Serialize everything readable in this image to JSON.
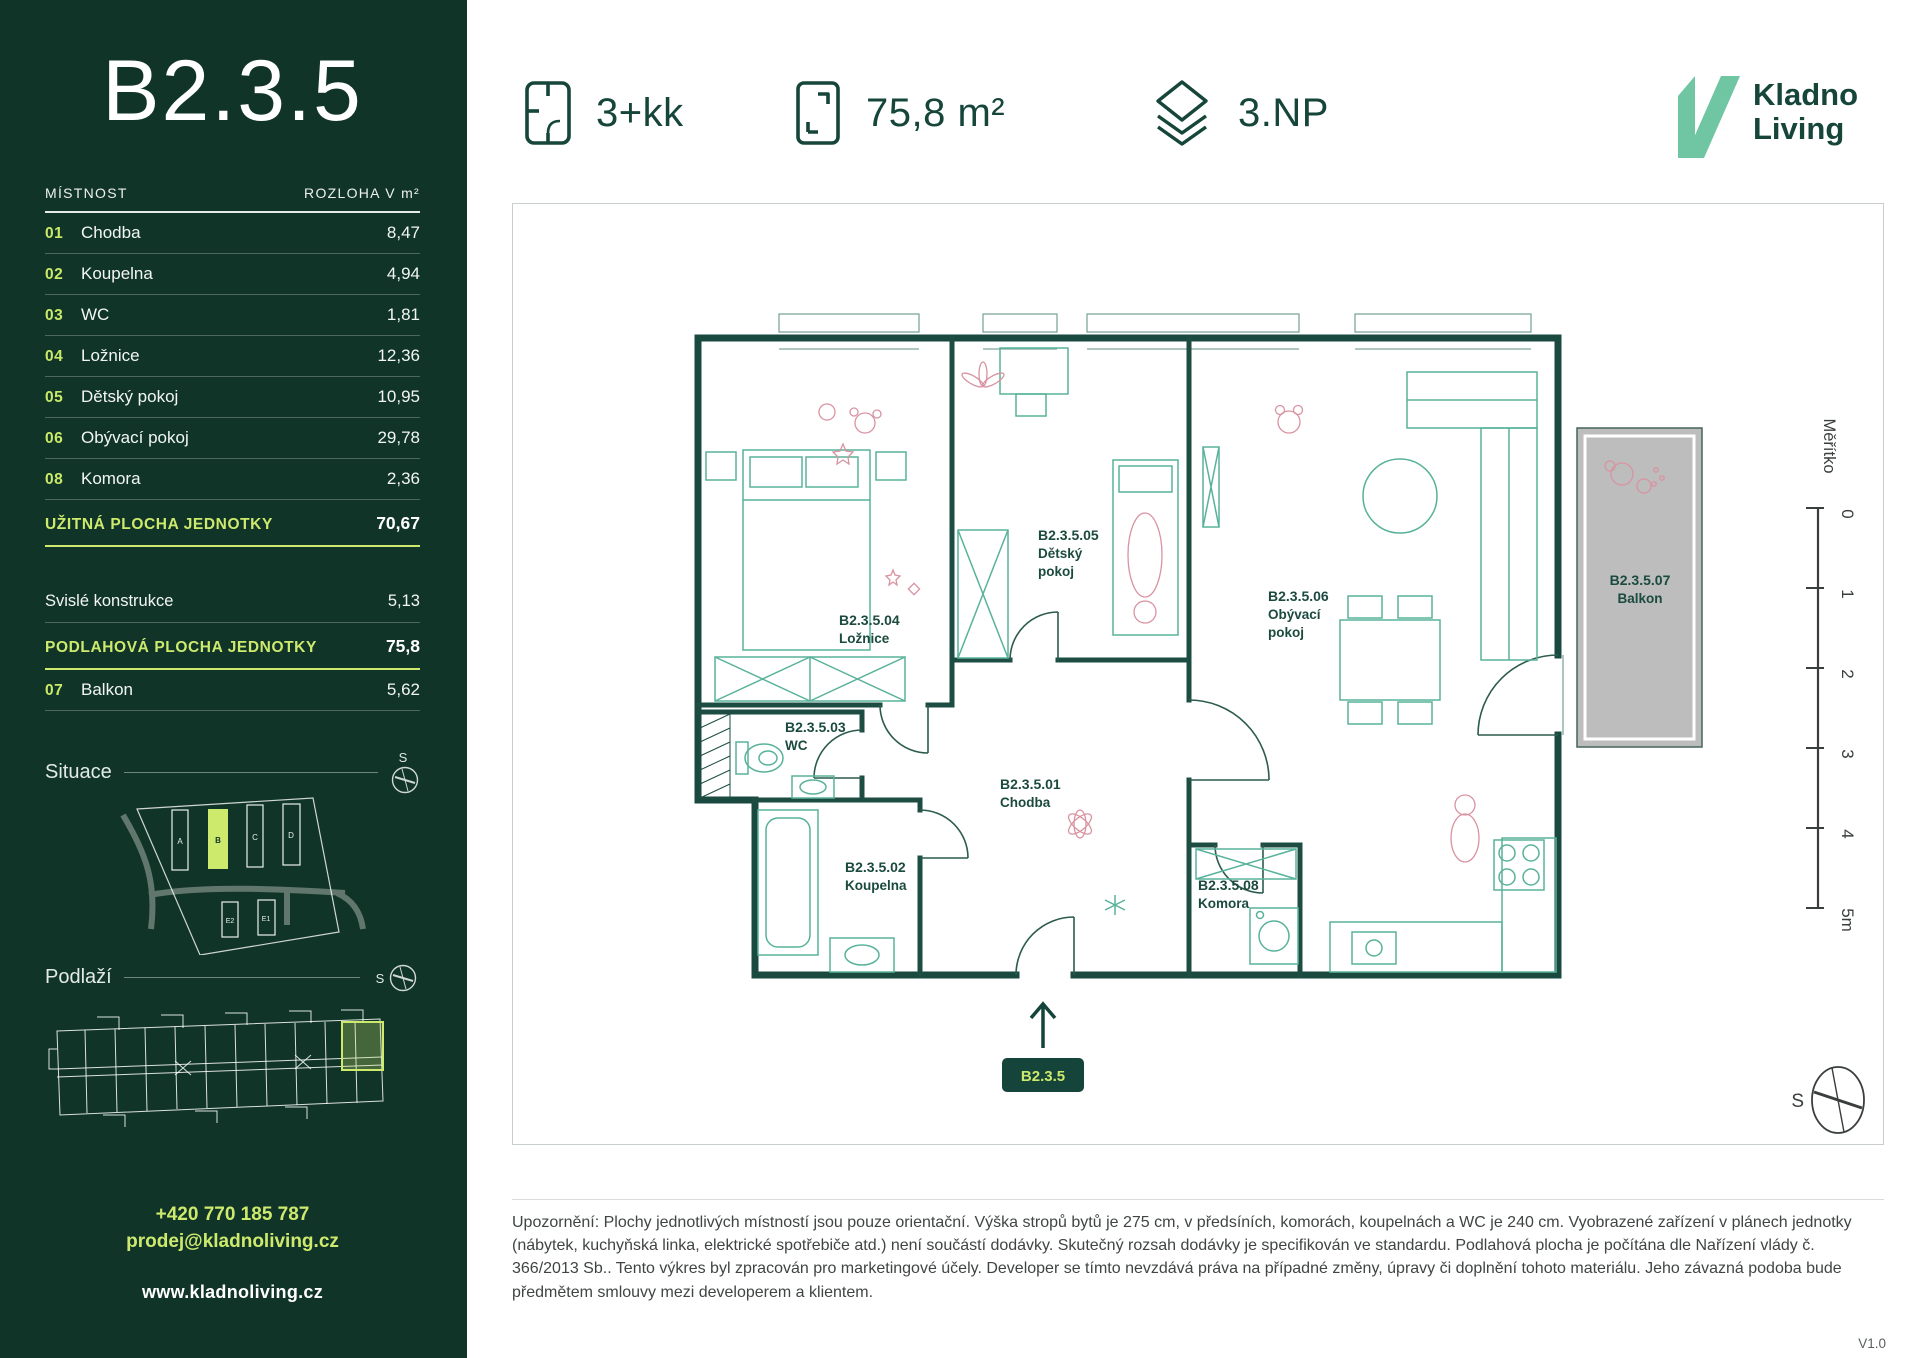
{
  "sidebar": {
    "unit_code": "B2.3.5",
    "table": {
      "header": {
        "room": "MÍSTNOST",
        "area": "ROZLOHA V m²"
      },
      "rows": [
        {
          "num": "01",
          "name": "Chodba",
          "area": "8,47"
        },
        {
          "num": "02",
          "name": "Koupelna",
          "area": "4,94"
        },
        {
          "num": "03",
          "name": "WC",
          "area": "1,81"
        },
        {
          "num": "04",
          "name": "Ložnice",
          "area": "12,36"
        },
        {
          "num": "05",
          "name": "Dětský pokoj",
          "area": "10,95"
        },
        {
          "num": "06",
          "name": "Obývací pokoj",
          "area": "29,78"
        },
        {
          "num": "08",
          "name": "Komora",
          "area": "2,36"
        }
      ],
      "usable": {
        "label": "UŽITNÁ PLOCHA JEDNOTKY",
        "area": "70,67"
      },
      "construction": {
        "label": "Svislé konstrukce",
        "area": "5,13"
      },
      "floor_area": {
        "label": "PODLAHOVÁ PLOCHA JEDNOTKY",
        "area": "75,8"
      },
      "balcony_row": {
        "num": "07",
        "name": "Balkon",
        "area": "5,62"
      }
    },
    "situace_label": "Situace",
    "podlazi_label": "Podlaží",
    "compass_letter": "S",
    "site_buildings": [
      "A",
      "B",
      "C",
      "D",
      "E2",
      "E1"
    ],
    "contact": {
      "phone": "+420 770 185 787",
      "email": "prodej@kladnoliving.cz",
      "web": "www.kladnoliving.cz"
    }
  },
  "header": {
    "layout": "3+kk",
    "area": "75,8 m²",
    "floor": "3.NP",
    "logo": {
      "line1": "Kladno",
      "line2": "Living"
    }
  },
  "plan": {
    "rooms": [
      {
        "id": "B2.3.5.01",
        "lines": [
          "Chodba"
        ]
      },
      {
        "id": "B2.3.5.02",
        "lines": [
          "Koupelna"
        ]
      },
      {
        "id": "B2.3.5.03",
        "lines": [
          "WC"
        ]
      },
      {
        "id": "B2.3.5.04",
        "lines": [
          "Ložnice"
        ]
      },
      {
        "id": "B2.3.5.05",
        "lines": [
          "Dětský",
          "pokoj"
        ]
      },
      {
        "id": "B2.3.5.06",
        "lines": [
          "Obývací",
          "pokoj"
        ]
      },
      {
        "id": "B2.3.5.07",
        "lines": [
          "Balkon"
        ]
      },
      {
        "id": "B2.3.5.08",
        "lines": [
          "Komora"
        ]
      }
    ],
    "unit_badge": "B2.3.5",
    "scale": {
      "label": "Měřítko",
      "ticks": [
        "0",
        "1",
        "2",
        "3",
        "4",
        "5m"
      ]
    },
    "compass_letter": "S"
  },
  "footer": {
    "disclaimer": "Upozornění: Plochy jednotlivých místností jsou pouze orientační. Výška stropů bytů je 275 cm, v předsíních, komorách, koupelnách a WC je 240 cm. Vyobrazené zařízení v plánech jednotky (nábytek, kuchyňská linka, elektrické spotřebiče atd.) není součástí dodávky. Skutečný rozsah dodávky je specifikován ve standardu. Podlahová plocha je počítána dle Nařízení vlády č. 366/2013 Sb.. Tento výkres byl zpracován pro marketingové účely. Developer se tímto nevzdává práva na případné změny, úpravy či doplnění tohoto materiálu. Jeho závazná podoba bude předmětem smlouvy mezi developerem a klientem.",
    "version": "V1.0"
  },
  "colors": {
    "sidebar_bg": "#113429",
    "lime": "#cdea6d",
    "dark_green": "#16453a",
    "logo_mint": "#70c6a3",
    "wall": "#1a4a3f",
    "furniture": "#58b29a",
    "decor_pink": "#d893a1",
    "balcony_gray": "#bdbdbd"
  }
}
